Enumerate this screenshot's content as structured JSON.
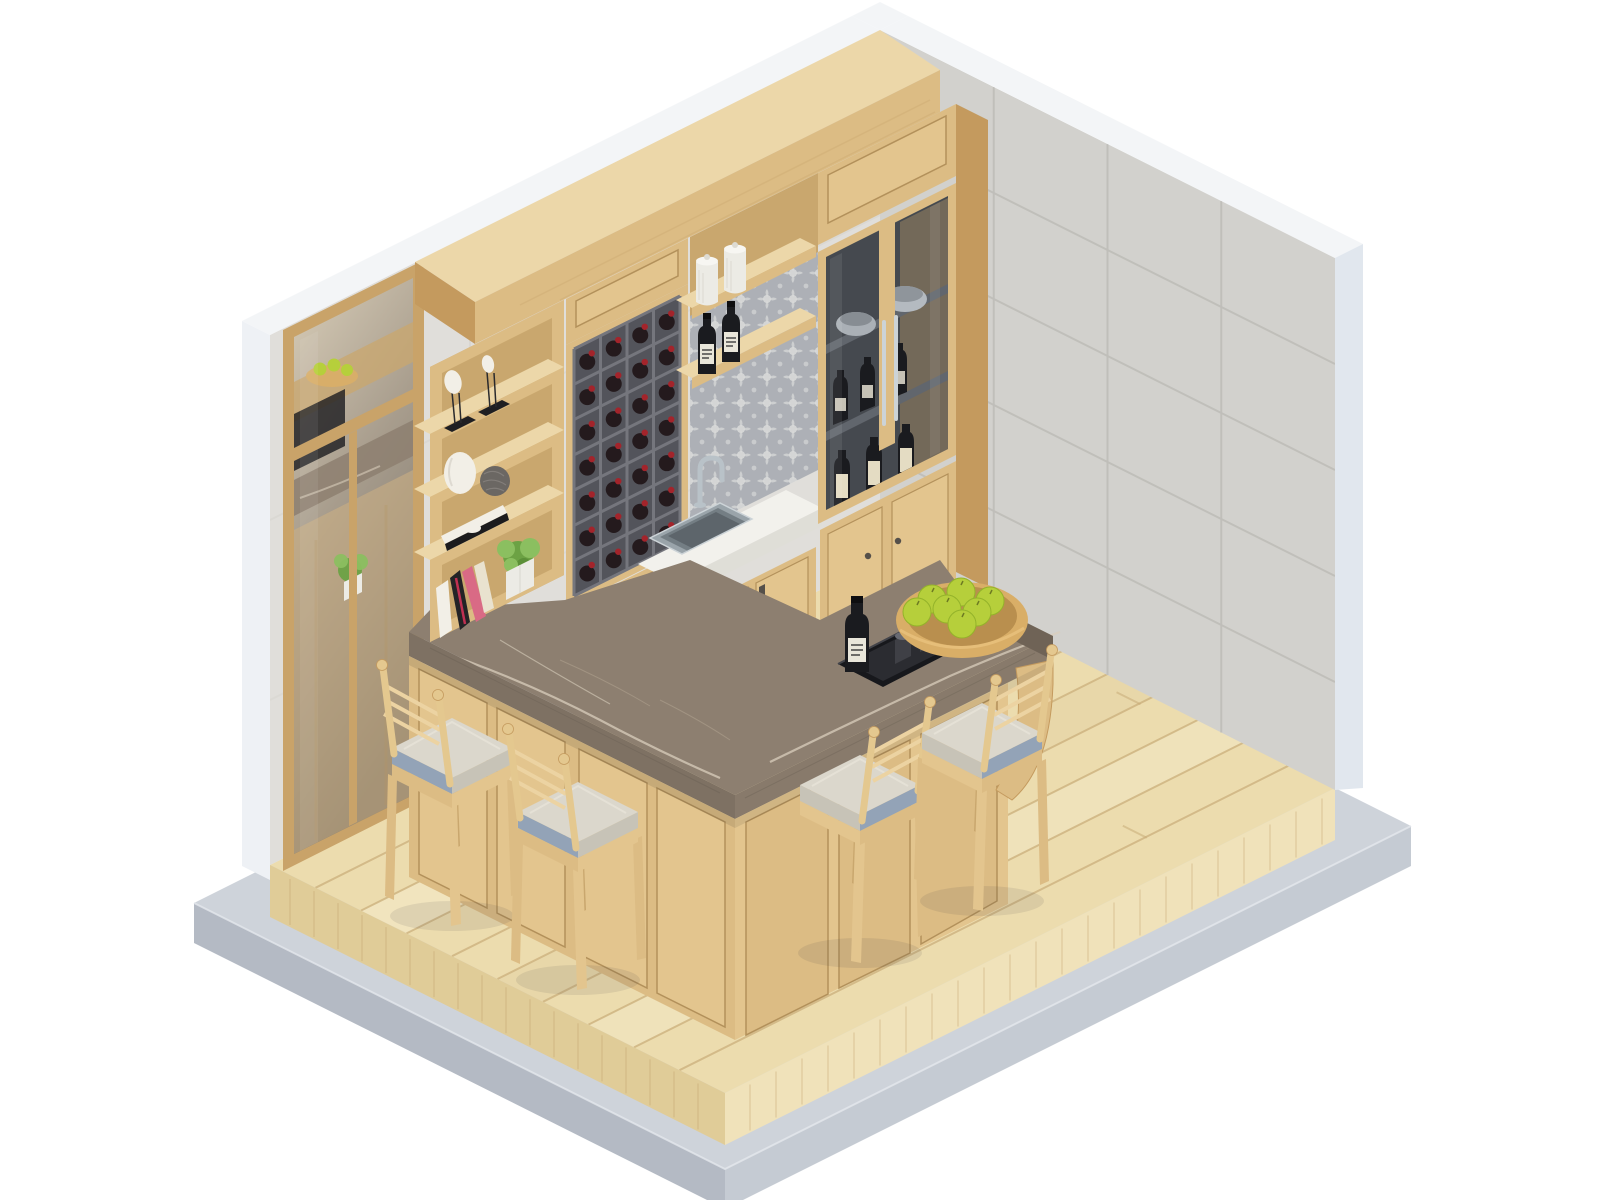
{
  "meta": {
    "alt": "Isometric 3D render of a compact home bar room: oak cabinetry with open shelves, wine rack, sink niche, glass display cabinet, L-shaped marble bar counter with four upholstered oak stools, a bowl of green apples and a black whiskey tray, on a light wood plank floor over a concrete plinth enclosed by two tiled walls and a tall mirror."
  },
  "scene": {
    "stools": 4,
    "apples": 7,
    "wine_rack": {
      "columns": 4,
      "rows": 7
    },
    "floor": {
      "planks": 10,
      "joints": 14
    },
    "right_wall_tiles": {
      "columns": 4,
      "rows": 5
    },
    "glass_cabinet": {
      "shelves": 3,
      "bowls": 2,
      "dark_bottles": 3,
      "label_bottles": 3
    },
    "sink_niche": {
      "jars": 2,
      "whiskey_bottles": 2,
      "shelves": 2
    },
    "open_shelving": {
      "shelves": 4,
      "books": 6,
      "sculptures": 2,
      "vases": 2,
      "plants": 1
    },
    "tray": {
      "glasses": 2,
      "bottles": 1
    }
  },
  "colors": {
    "bg": "#ffffff",
    "wall_edge": "#eef1f5",
    "wall_edge_shade": "#e1e7ee",
    "band_white": "#f3f5f7",
    "wall_left": "#e0deda",
    "wall_left_line": "#d2d0cb",
    "wall_right": "#d2d1cd",
    "grout": "#bfbeb9",
    "slab_top": "#ced3da",
    "slab_left": "#b4bac4",
    "slab_right": "#c5cbd3",
    "floor_top": "#ecdcae",
    "floor_light": "#f5ebcd",
    "floor_mid": "#e4d1a4",
    "floor_line": "#c9ad79",
    "floor_left": "#e0cc98",
    "floor_right": "#f0e2ba",
    "floor_grain": "#cdb07c",
    "oak_top": "#ecd7a9",
    "oak_front": "#dcbc84",
    "oak_panel": "#e3c58e",
    "oak_deep": "#c9a76e",
    "oak_side": "#c49a5e",
    "oak_recess": "#b3915b",
    "marble": "#8d7f70",
    "marble_front": "#7e7163",
    "marble_front2": "#887a6b",
    "marble_end": "#6f6356",
    "vein": "#d9cebc",
    "vein2": "#b5a794",
    "white_counter": "#f2f1ec",
    "white_counter_side": "#dfded7",
    "steel": "#9aa4aa",
    "steel_mid": "#747e84",
    "steel_dark": "#5d656b",
    "steel_light": "#ccd3d7",
    "chrome": "#b9c2c8",
    "rack_dark": "#53545b",
    "rack_line": "#75767d",
    "wine_body": "#241a1d",
    "wine_red": "#a3242b",
    "glass_bg": "#45494f",
    "glass_shelf": "#61666d",
    "bowl_gray": "#aab0b6",
    "bowl_gray2": "#b4bac0",
    "bottle_black": "#1a1b1f",
    "label": "#e9e6da",
    "label_cream": "#e4dcc3",
    "damask_bg": "#b4b7bc",
    "damask_fg": "#e9e9e7",
    "cushion": "#dbd7cc",
    "cushion_shade": "#c7c3b7",
    "cushion_blue": "#93a3b7",
    "stool_wood": "#e4c88f",
    "rail_wood": "#ecd3a2",
    "apple": "#b6cf3b",
    "apple_dark": "#94b32a",
    "bowl_wood": "#d9ae67",
    "bowl_wood_dark": "#b98f4e",
    "bowl_wood_hi": "#e8c27e",
    "tray": "#17181c",
    "tray_inner": "#2b2c31",
    "glass_cup": "#3f4046",
    "glass_cup_rim": "#686a72",
    "mirror_frame": "#c9a369",
    "plant_g1": "#6ca244",
    "plant_g2": "#8bbf60",
    "plant_g3": "#5c9038",
    "pot": "#ecebe5",
    "book_white": "#f2efe7",
    "book_black": "#232326",
    "book_red": "#c03052",
    "book_pink": "#d96a85",
    "book_cream": "#e9e2cf",
    "hardware": "#55504a",
    "shadow": "rgba(60,60,70,0.10)"
  }
}
